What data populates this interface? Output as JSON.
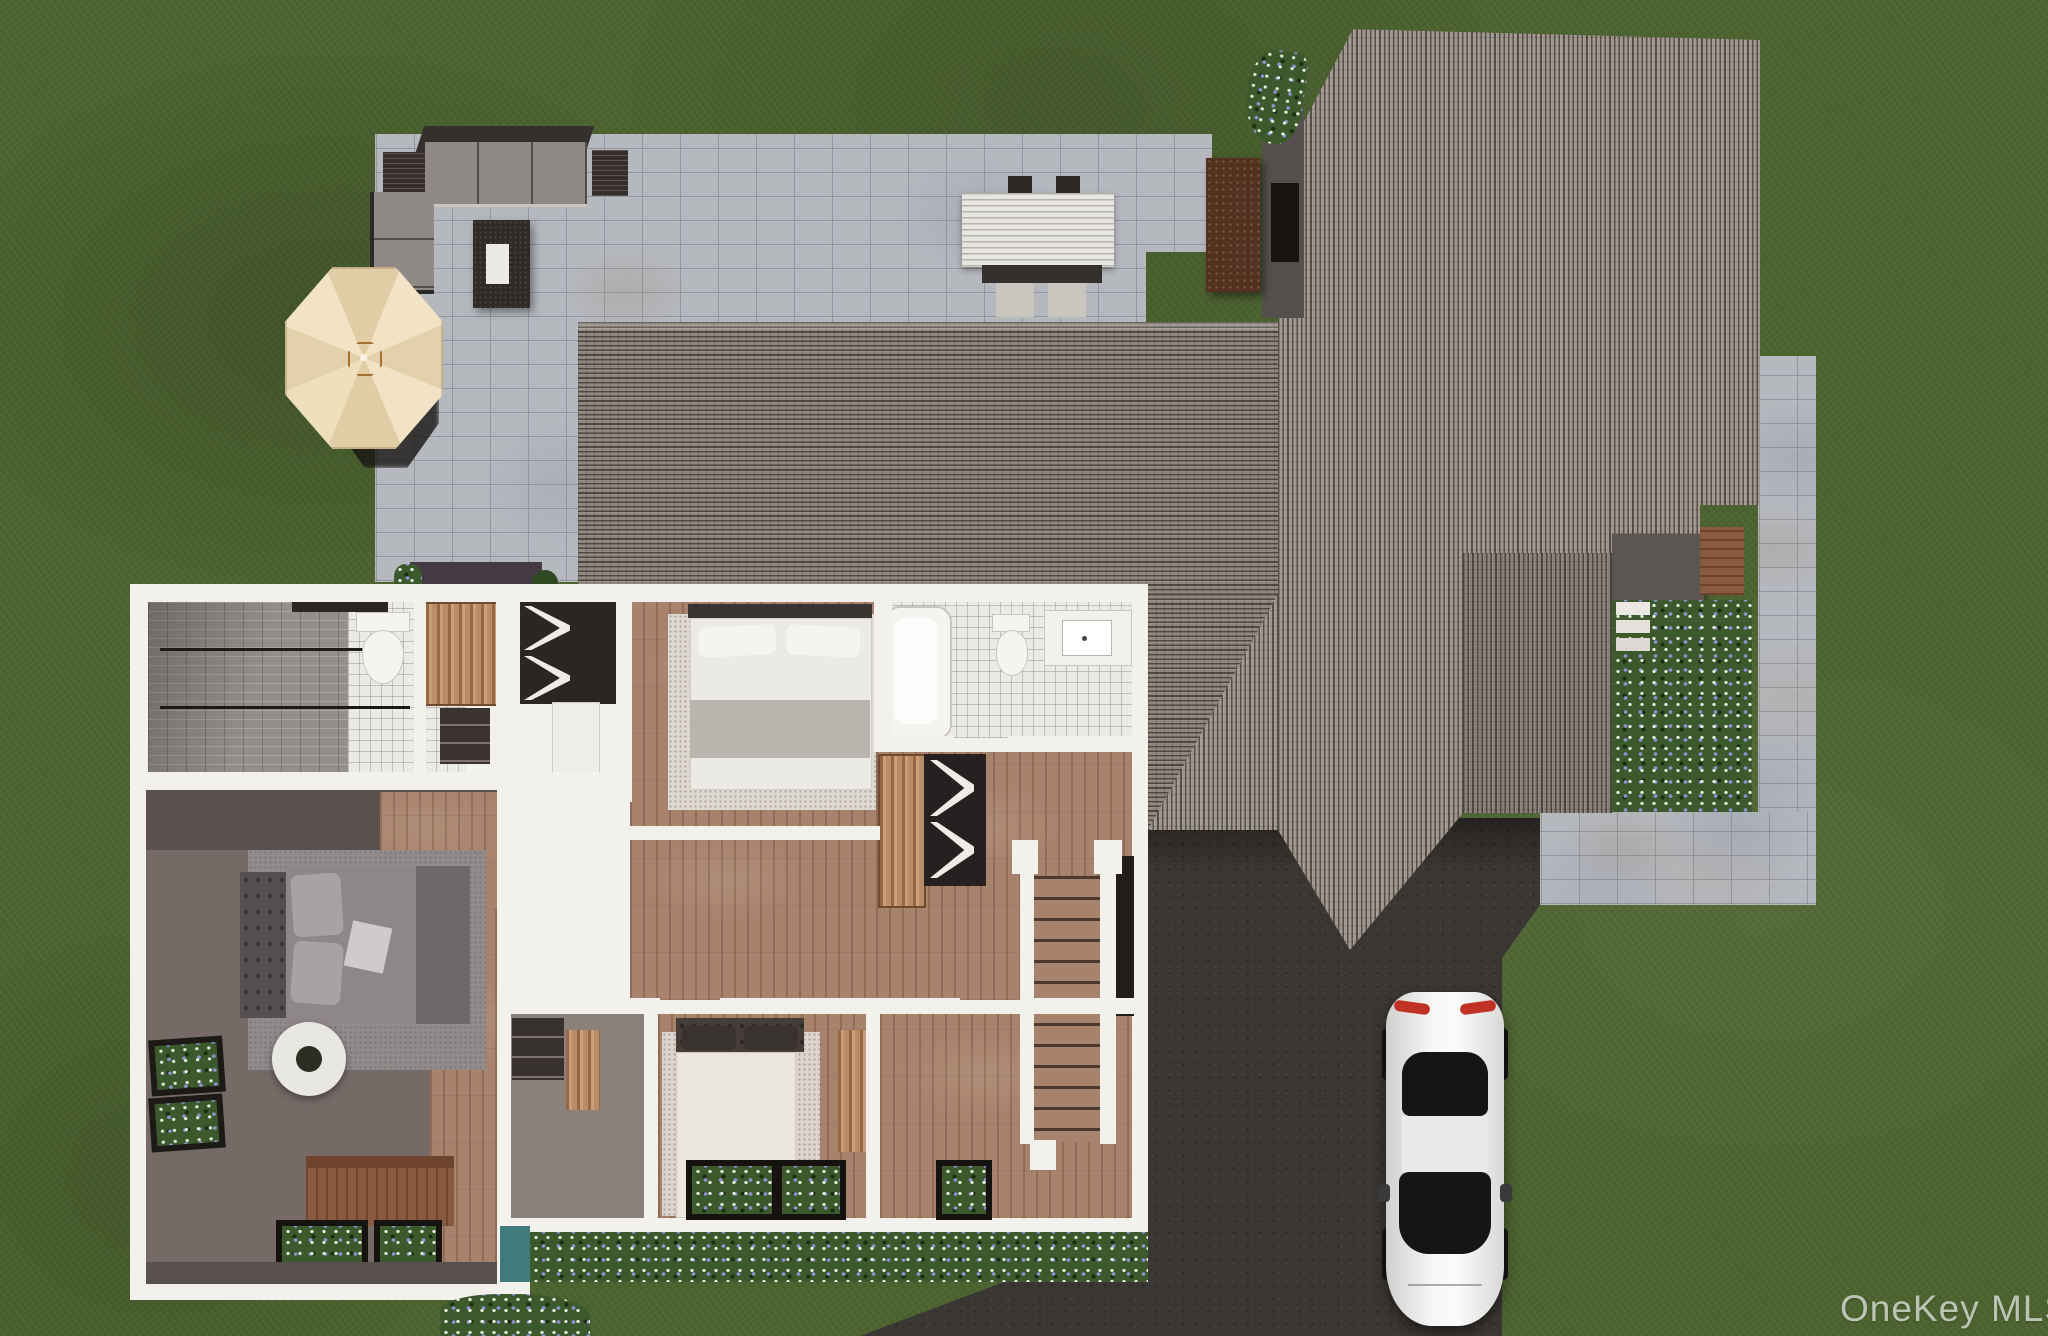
{
  "watermark": {
    "text": "OneKey MLS"
  },
  "palette": {
    "grass": "#4d6430",
    "paver": "#b5b8bd",
    "driveway": "#3a3633",
    "roof_h": "#8f867d",
    "roof_v": "#a0978e",
    "roof_vd": "#89807a",
    "wall": "#f3f1ec",
    "wood": "#a8836c",
    "cabinet": "#b98d66",
    "tile": "#eceae6",
    "shower": "#938f8c",
    "fgreen": "#3c592b",
    "fwhite": "#e8ecdf",
    "fblue": "#8b93d6",
    "cushion": "#8f8a87",
    "furndark": "#2f2a28",
    "counter": "#53301f",
    "deck": "#8a5a3e",
    "porch": "#5c5653",
    "teal": "#3f7a7c",
    "umbrella": "#f0e2c2",
    "umbseam": "#d9c6a0",
    "bedgray": "#8e8789",
    "headboard": "#55504f",
    "duvet": "#ece7de",
    "carwhite": "#f4f4f2",
    "carglass": "#131517",
    "taillight": "#c03224",
    "watermark": "#d5dad2"
  }
}
